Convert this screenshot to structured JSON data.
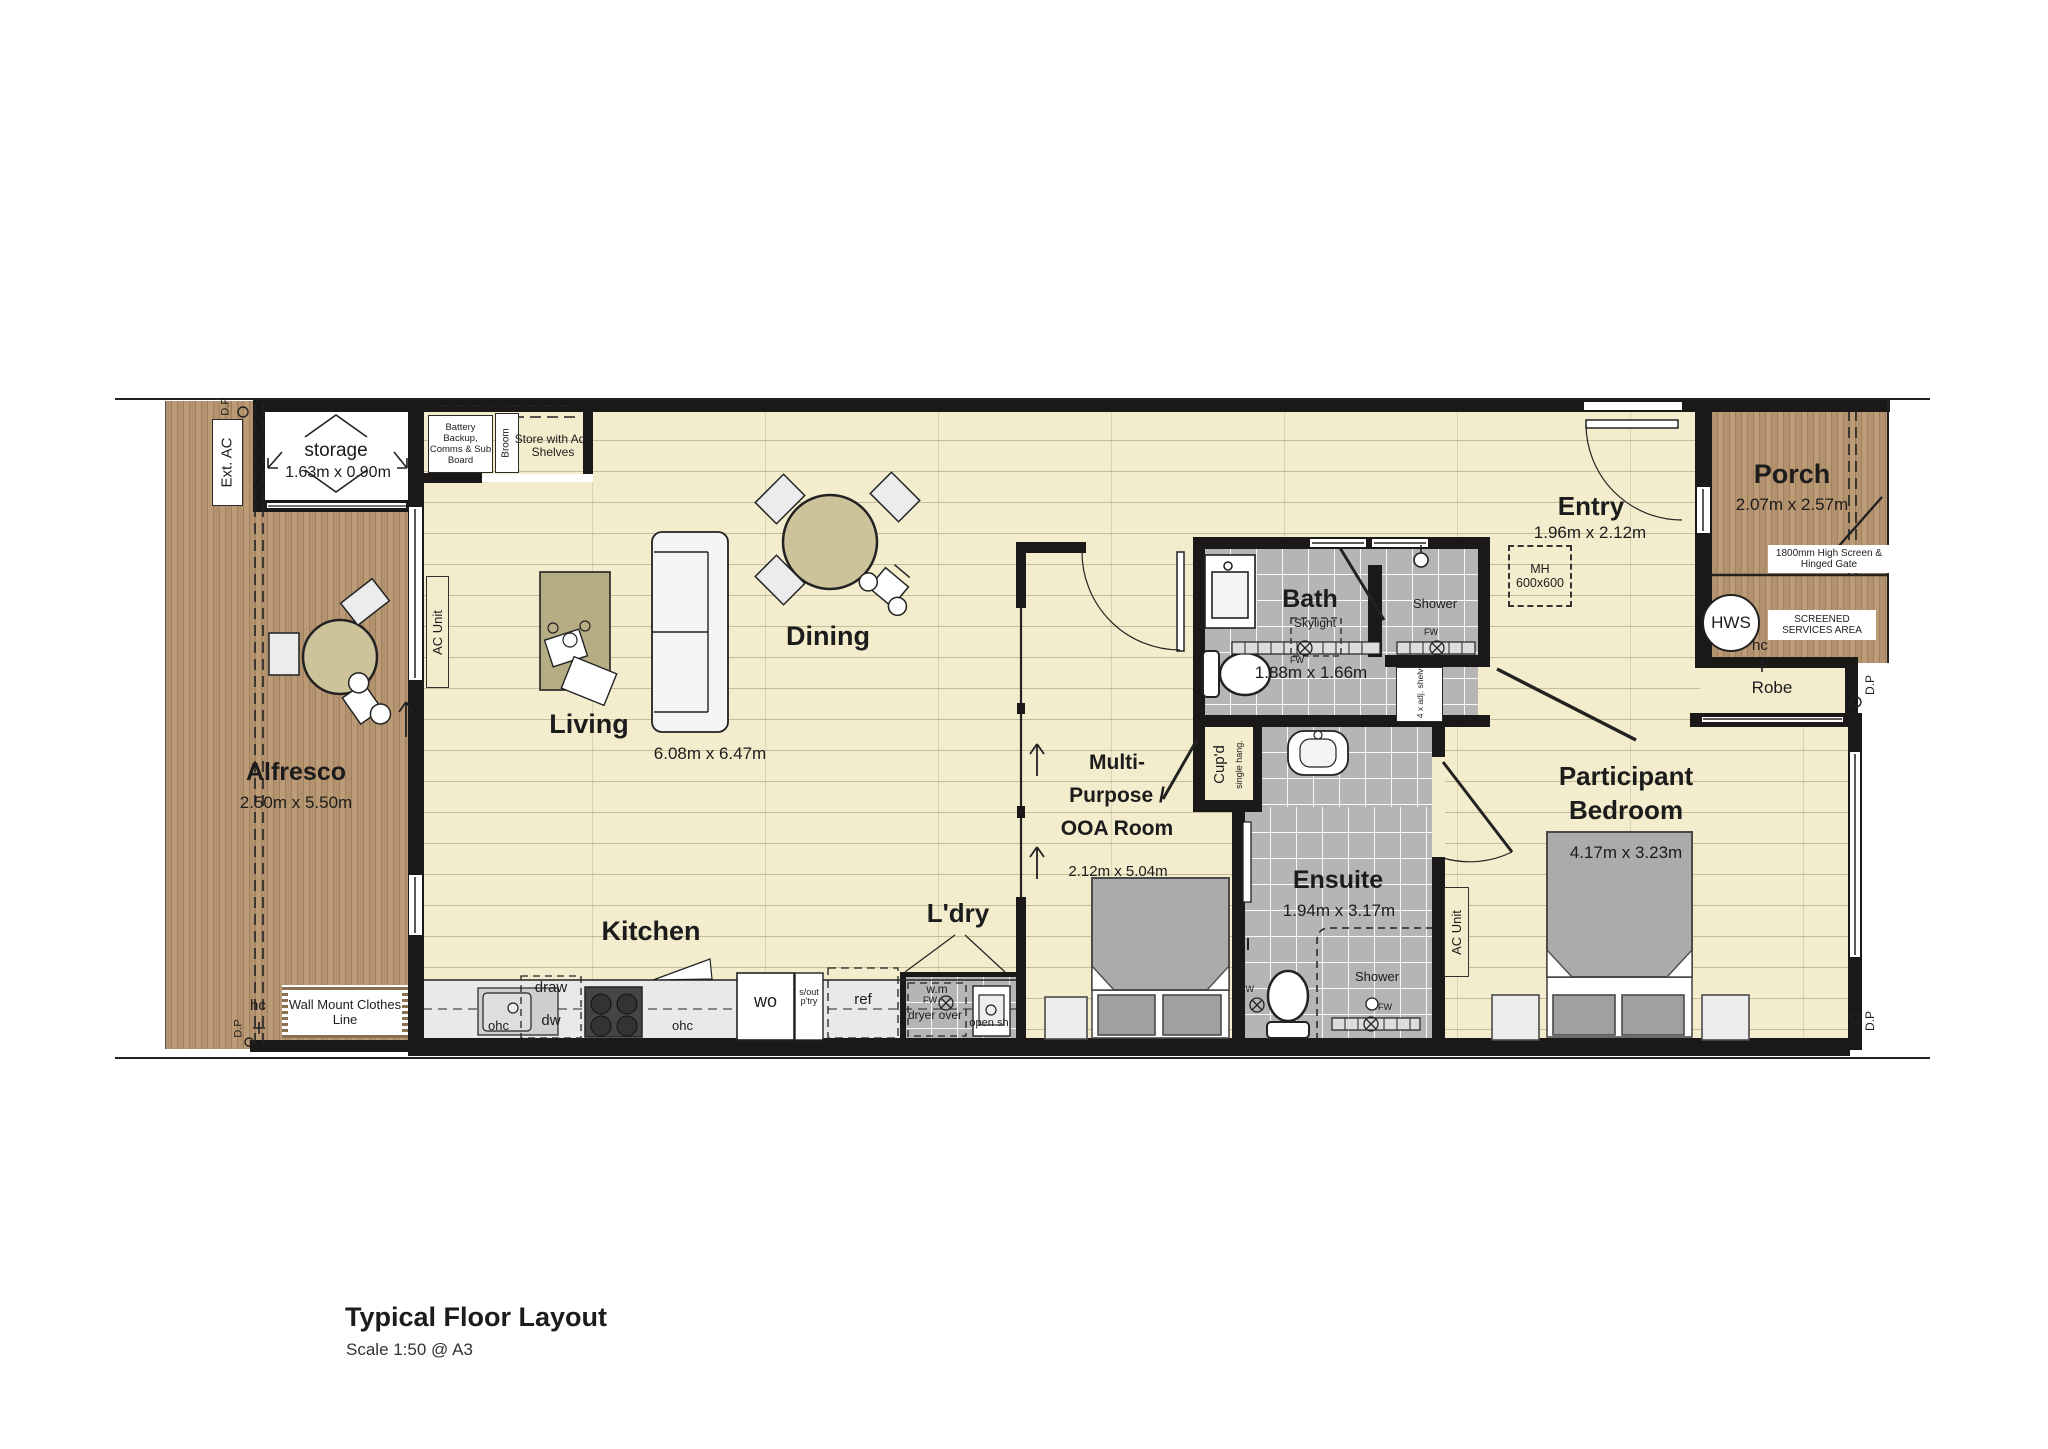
{
  "page": {
    "title": "Typical Floor Layout",
    "scale": "Scale 1:50 @ A3"
  },
  "colors": {
    "wall": "#1b1918",
    "floor": "#f3edcd",
    "deck": "#b3926f",
    "tile": "#b5b5b5",
    "accent_tan": "#cdc39b"
  },
  "rooms": {
    "alfresco": {
      "name": "Alfresco",
      "dims": "2.50m x 5.50m"
    },
    "storage": {
      "name": "storage",
      "dims": "1.63m x 0.90m"
    },
    "living": {
      "name": "Living",
      "dims": "6.08m x 6.47m"
    },
    "dining": {
      "name": "Dining"
    },
    "kitchen": {
      "name": "Kitchen"
    },
    "laundry": {
      "name": "L'dry"
    },
    "multipurpose": {
      "line1": "Multi-",
      "line2": "Purpose /",
      "line3": "OOA Room",
      "dims": "2.12m x 5.04m"
    },
    "bath": {
      "name": "Bath",
      "dims": "1.88m x 1.66m"
    },
    "ensuite": {
      "name": "Ensuite",
      "dims": "1.94m x 3.17m"
    },
    "entry": {
      "name": "Entry",
      "dims": "1.96m x 2.12m"
    },
    "porch": {
      "name": "Porch",
      "dims": "2.07m x 2.57m"
    },
    "bedroom": {
      "line1": "Participant",
      "line2": "Bedroom",
      "dims": "4.17m x 3.23m"
    },
    "robe": {
      "name": "Robe"
    }
  },
  "labels": {
    "ext_ac": "Ext. AC",
    "dp": "D.P",
    "battery": "Battery Backup, Comms & Sub Board",
    "broom": "Broom",
    "store_shelves": "Store with Adj. Shelves",
    "ac_unit": "AC Unit",
    "skylight": "Skylight",
    "shower": "Shower",
    "fw": "FW",
    "mh": "MH 600x600",
    "hws": "HWS",
    "hc": "hc",
    "high_screen": "1800mm High Screen & Hinged Gate",
    "screened_services": "SCREENED SERVICES AREA",
    "adj_shelves": "4 x adj. shelves",
    "cupd": "Cup'd",
    "single_hang": "single hang.",
    "clothes_line": "Wall Mount Clothes Line",
    "ohc": "ohc",
    "draw": "draw",
    "dw": "dw",
    "wo": "wo",
    "sout_ptry": "s/out p'try",
    "ref": "ref",
    "wm": "w.m",
    "dryer_over": "dryer over",
    "open_sh": "open sh"
  }
}
